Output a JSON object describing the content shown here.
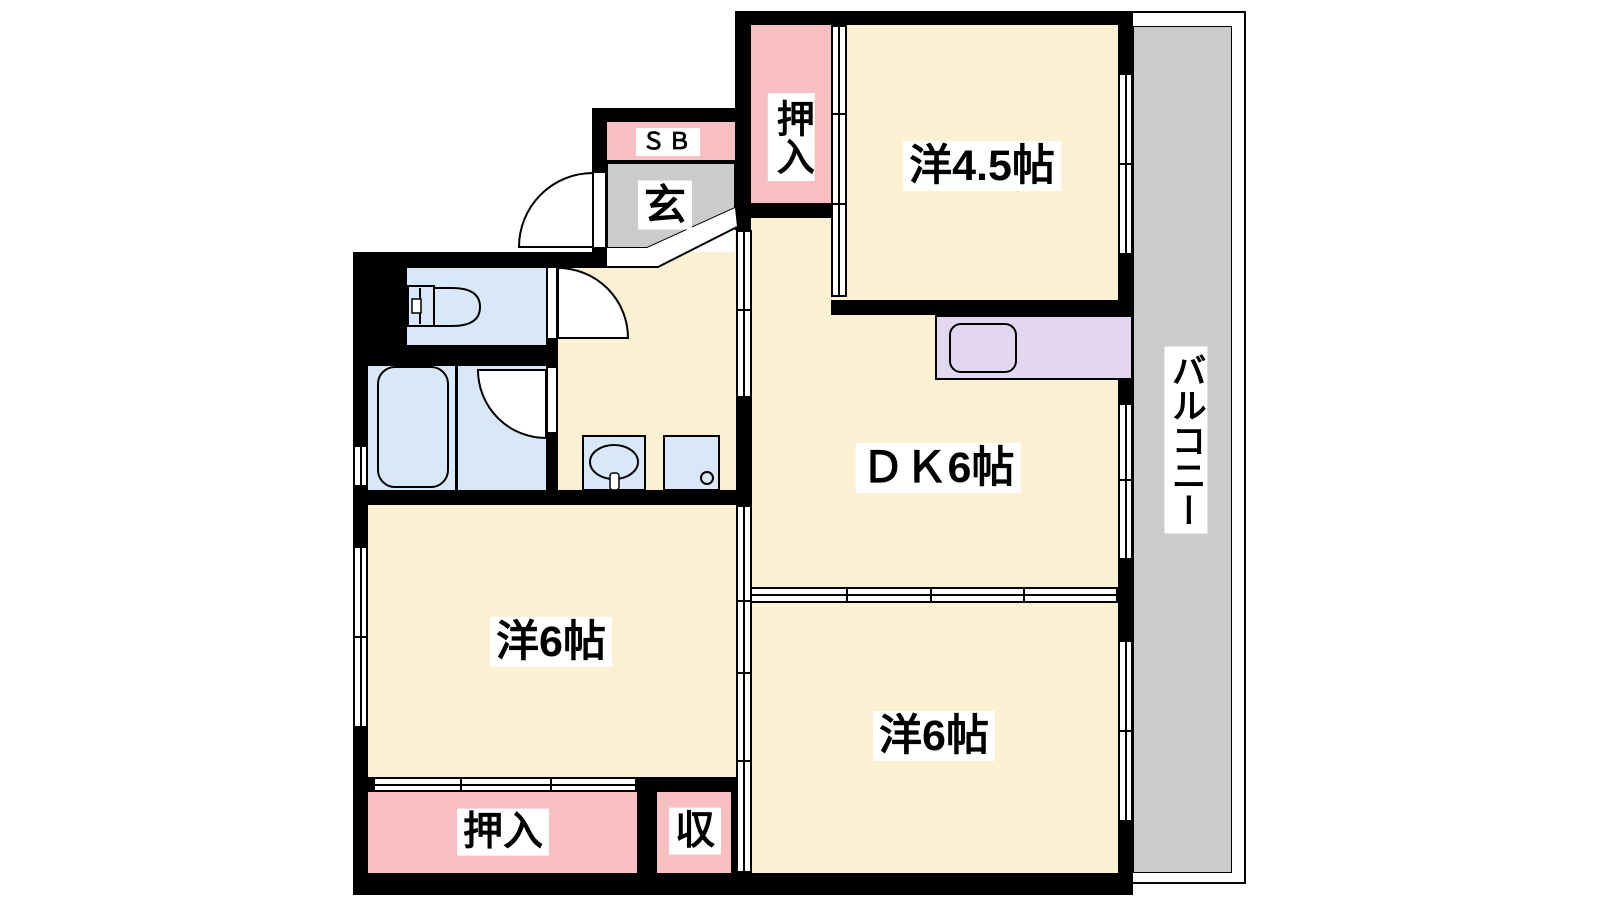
{
  "floorplan": {
    "labels": {
      "western_4_5": "洋4.5帖",
      "dining_kitchen": "ＤＫ6帖",
      "western_6_left": "洋6帖",
      "western_6_right": "洋6帖",
      "closet_upper": "押入",
      "closet_lower": "押入",
      "storage": "収",
      "shoe_box": "ＳＢ",
      "entrance": "玄",
      "balcony": "バルコニー"
    },
    "colors": {
      "wall": "#000000",
      "room_floor": "#FCF0D2",
      "closet_floor": "#F7BFC1",
      "entrance_floor": "#CBCBCB",
      "balcony_floor": "#CBCBCB",
      "wet_area_floor": "#D9E8F8",
      "kitchen_counter": "#E3D7F0",
      "background": "#FFFFFF"
    }
  }
}
